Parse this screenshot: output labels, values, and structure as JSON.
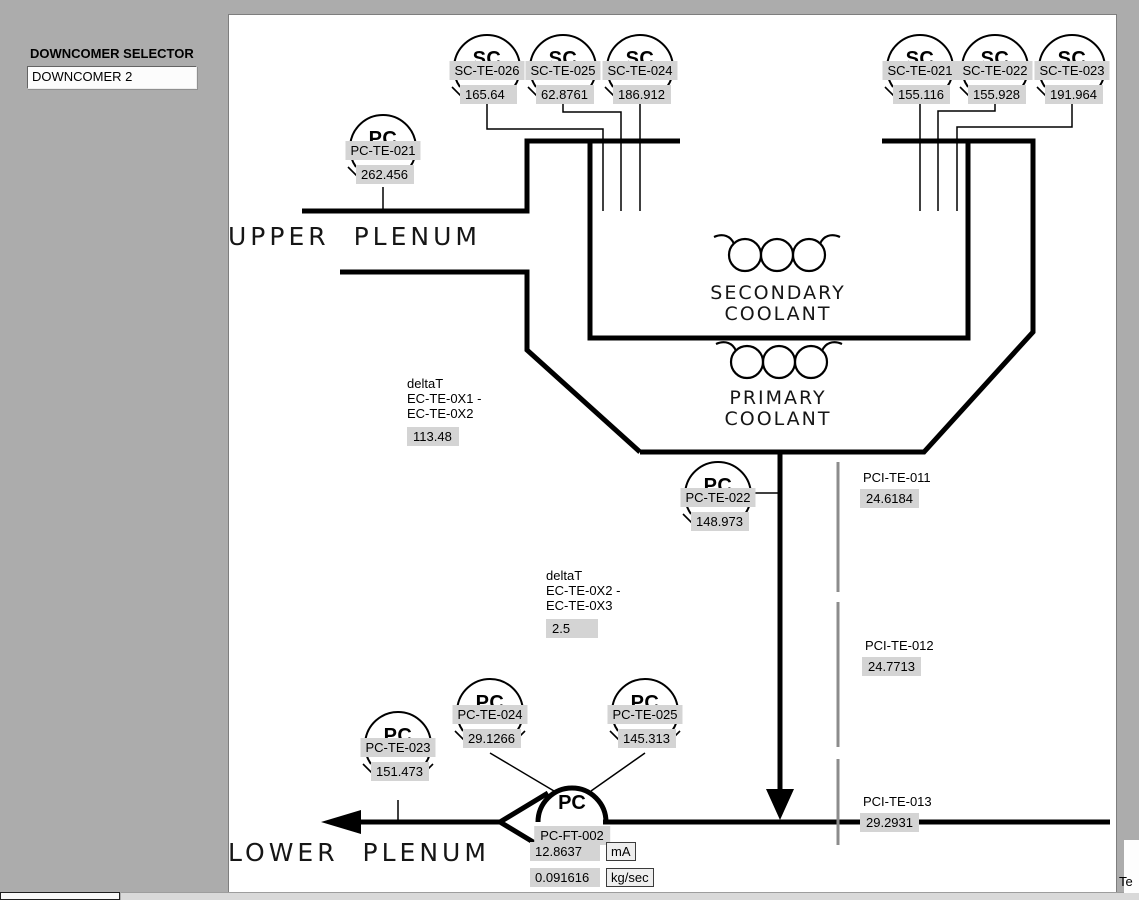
{
  "selector": {
    "label": "DOWNCOMER SELECTOR",
    "value": "DOWNCOMER 2"
  },
  "regions": {
    "upper_plenum": "UPPER PLENUM",
    "lower_plenum": "LOWER PLENUM",
    "secondary_line1": "SECONDARY",
    "secondary_line2": "COOLANT",
    "primary_line1": "PRIMARY",
    "primary_line2": "COOLANT"
  },
  "sensors": [
    {
      "kind": "SC",
      "tag": "SC-TE-026",
      "value": "165.64"
    },
    {
      "kind": "SC",
      "tag": "SC-TE-025",
      "value": "62.8761"
    },
    {
      "kind": "SC",
      "tag": "SC-TE-024",
      "value": "186.912"
    },
    {
      "kind": "SC",
      "tag": "SC-TE-021",
      "value": "155.116"
    },
    {
      "kind": "SC",
      "tag": "SC-TE-022",
      "value": "155.928"
    },
    {
      "kind": "SC",
      "tag": "SC-TE-023",
      "value": "191.964"
    },
    {
      "kind": "PC",
      "tag": "PC-TE-021",
      "value": "262.456"
    },
    {
      "kind": "PC",
      "tag": "PC-TE-022",
      "value": "148.973"
    },
    {
      "kind": "PC",
      "tag": "PC-TE-024",
      "value": "29.1266"
    },
    {
      "kind": "PC",
      "tag": "PC-TE-025",
      "value": "145.313"
    },
    {
      "kind": "PC",
      "tag": "PC-TE-023",
      "value": "151.473"
    }
  ],
  "flow_sensor": {
    "kind": "PC",
    "tag": "PC-FT-002",
    "current_value": "12.8637",
    "current_unit": "mA",
    "flow_value": "0.091616",
    "flow_unit": "kg/sec"
  },
  "delta_t": [
    {
      "title": "deltaT",
      "line1": "EC-TE-0X1 -",
      "line2": "EC-TE-0X2",
      "value": "113.48"
    },
    {
      "title": "deltaT",
      "line1": "EC-TE-0X2 -",
      "line2": "EC-TE-0X3",
      "value": "2.5"
    }
  ],
  "pci": [
    {
      "tag": "PCI-TE-011",
      "value": "24.6184"
    },
    {
      "tag": "PCI-TE-012",
      "value": "24.7713"
    },
    {
      "tag": "PCI-TE-013",
      "value": "29.2931"
    }
  ],
  "corner_text": "Te",
  "colors": {
    "background": "#acacac",
    "indicator_box": "#d4d4d4",
    "panel": "#ffffff"
  }
}
